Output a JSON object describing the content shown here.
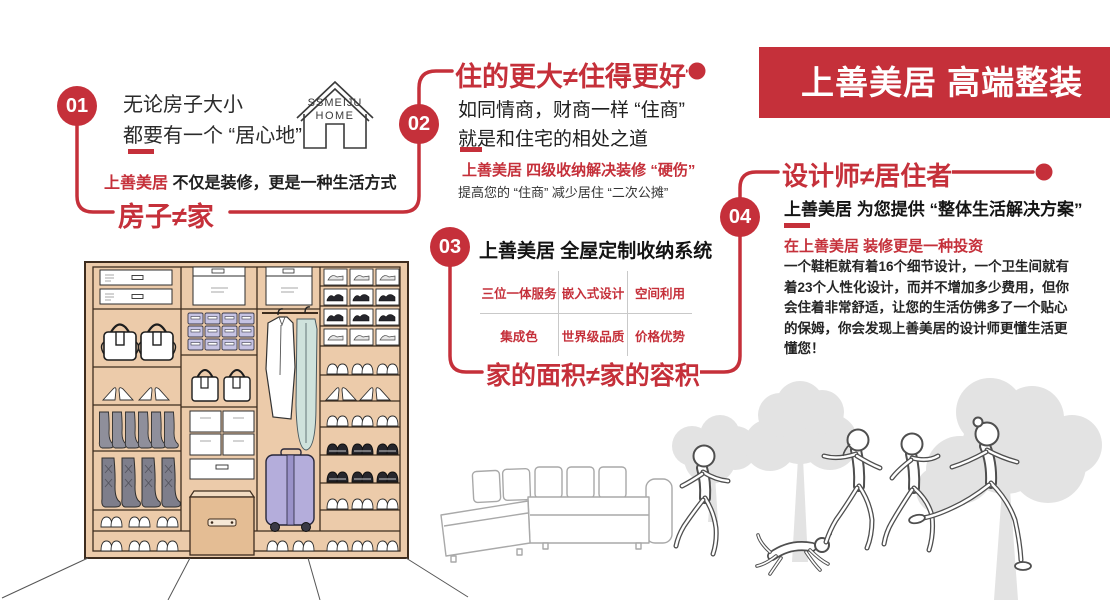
{
  "banner": {
    "title": "上善美居 高端整装"
  },
  "colors": {
    "brand_red": "#c5303a",
    "text_dark": "#1f1f1f",
    "wardrobe_tan": "#eccbaa",
    "silhouette_gray": "#e3e3e3"
  },
  "logo": {
    "line1": "SSMEIJU",
    "line2": "HOME"
  },
  "sections": {
    "s1": {
      "num": "01",
      "line1": "无论房子大小",
      "line2": "都要有一个 “居心地”",
      "sub_red": "上善美居",
      "sub_black": " 不仅是装修，更是一种生活方式",
      "headline": "房子≠家"
    },
    "s2": {
      "num": "02",
      "headline": "住的更大≠住得更好",
      "line1": "如同情商，财商一样 “住商”",
      "line2": "就是和住宅的相处之道",
      "sub_red": "上善美居 四级收纳解决装修 “硬伤”",
      "sub_black": "提高您的 “住商” 减少居住 “二次公摊”"
    },
    "s3": {
      "num": "03",
      "title": "上善美居 全屋定制收纳系统",
      "grid": [
        [
          "三位一体服务",
          "嵌入式设计",
          "空间利用"
        ],
        [
          "集成色",
          "世界级品质",
          "价格优势"
        ]
      ],
      "headline": "家的面积≠家的容积"
    },
    "s4": {
      "num": "04",
      "headline": "设计师≠居住者",
      "title": "上善美居 为您提供 “整体生活解决方案”",
      "sub_red": "在上善美居 装修更是一种投资",
      "paragraph": "一个鞋柜就有着16个细节设计，一个卫生间就有着23个人性化设计，而并不增加多少费用，但你会住着非常舒适，让您的生活仿佛多了一个贴心的保姆，你会发现上善美居的设计师更懂生活更懂您！"
    }
  },
  "illustrations": {
    "wardrobe": "wardrobe-storage-illustration",
    "sofa": "sectional-sofa-sketch",
    "scene": "running-family-with-dog-and-trees"
  }
}
